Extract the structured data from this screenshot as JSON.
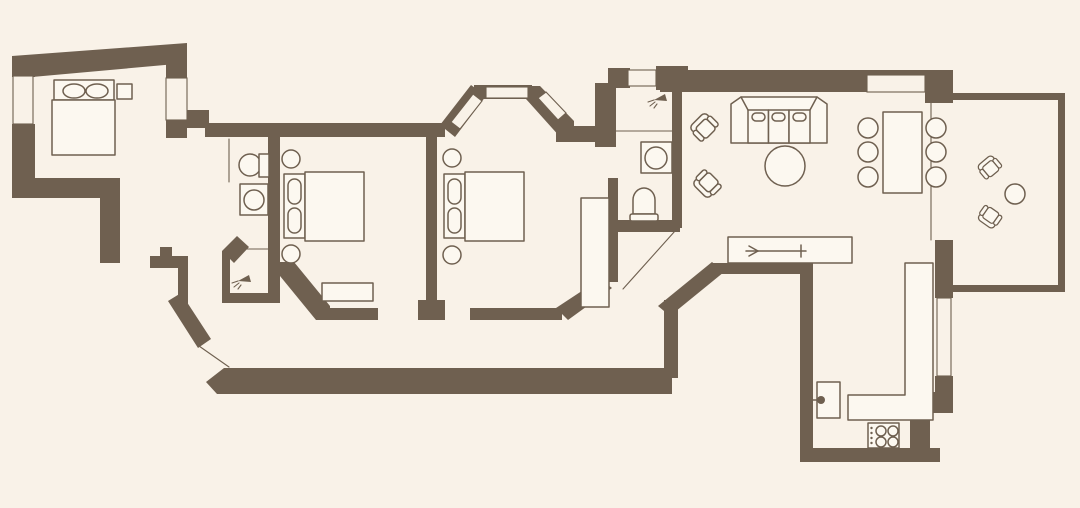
{
  "colors": {
    "background": "#F9F2E8",
    "wall": "#6F6050",
    "line": "#6F6050",
    "furniture-fill": "#FCF8F0"
  },
  "plan": {
    "kind": "apartment-floor-plan",
    "rooms": [
      {
        "name": "bedroom-1",
        "items": [
          "double-bed",
          "pillow",
          "pillow",
          "nightstand",
          "window",
          "window"
        ]
      },
      {
        "name": "hallway",
        "items": [
          "door-opening"
        ]
      },
      {
        "name": "bathroom-1",
        "items": [
          "toilet",
          "washing-machine"
        ]
      },
      {
        "name": "shower-room",
        "items": [
          "shower-head"
        ]
      },
      {
        "name": "bedroom-2",
        "items": [
          "double-bed",
          "pillow",
          "pillow",
          "round-nightstand",
          "round-nightstand",
          "bench"
        ]
      },
      {
        "name": "bedroom-3",
        "items": [
          "double-bed",
          "pillow",
          "pillow",
          "round-nightstand",
          "round-nightstand",
          "wardrobe",
          "bay-window",
          "bay-window",
          "bay-window"
        ]
      },
      {
        "name": "bathroom-2",
        "items": [
          "shower-head",
          "shower-tray",
          "sink",
          "toilet",
          "window"
        ]
      },
      {
        "name": "living-dining-room",
        "items": [
          "sofa",
          "coffee-table",
          "armchair",
          "armchair",
          "dining-table",
          "dining-chair",
          "dining-chair",
          "dining-chair",
          "dining-chair",
          "dining-chair",
          "dining-chair",
          "bar-counter",
          "sliding-door-symbol",
          "window"
        ]
      },
      {
        "name": "kitchen",
        "items": [
          "kitchen-sink",
          "stove",
          "counter",
          "window"
        ]
      },
      {
        "name": "balcony",
        "items": [
          "patio-chair",
          "patio-chair",
          "side-table"
        ]
      }
    ]
  }
}
